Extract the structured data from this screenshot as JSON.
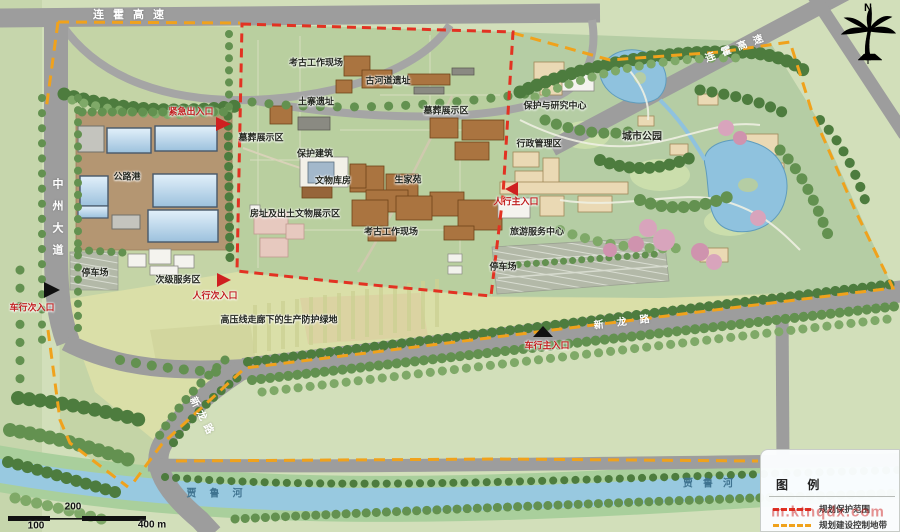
{
  "roads": {
    "lianhuo_top": "连霍高速",
    "lianhuo_ne": "连霍高速",
    "zhongzhou": "中州大道",
    "xinlong_e": "新龙路",
    "xinlong_sw": "新龙路"
  },
  "rivers": {
    "jialuhe_w": "贾鲁河",
    "jialuhe_e": "贾鲁河"
  },
  "areas": {
    "gonglugang": "公路港",
    "tingchechang_left": "停车场",
    "cijifuwuqu": "次级服务区",
    "kaogu_top": "考古工作现场",
    "guhedao": "古河道遗址",
    "tuzhai": "土寨遗址",
    "muzang_left": "墓葬展示区",
    "muzang_right": "墓葬展示区",
    "baohu_jianzhu": "保护建筑",
    "wenwu_kufang": "文物库房",
    "shengjiayuan": "生家苑",
    "fangzhi": "房址及出土文物展示区",
    "kaogu_bottom": "考古工作现场",
    "baohu_yanjiu": "保护与研究中心",
    "xingzheng": "行政管理区",
    "chengshi_gongyuan": "城市公园",
    "lvyou_fuwu": "旅游服务中心",
    "tingchechang_right": "停车场",
    "gaoyaxian": "高压线走廊下的生产防护绿地"
  },
  "entrances": {
    "jinji": "紧急出入口",
    "renxing_ci": "人行次入口",
    "chexing_ci": "车行次入口",
    "renxing_zhu": "人行主入口",
    "chexing_zhu": "车行主入口"
  },
  "north_label": "N",
  "scale": {
    "m100": "100",
    "m200": "200",
    "m400": "400 m"
  },
  "legend": {
    "title": "图 例",
    "items": [
      {
        "name": "protection-scope",
        "label": "规划保护范围",
        "color": "#e23222",
        "style": "dashed"
      },
      {
        "name": "construction-control-zone",
        "label": "规划建设控制地带",
        "color": "#f0a21c",
        "style": "dashed"
      }
    ]
  },
  "watermark": "m.ktnqdx.com",
  "colors": {
    "protection_boundary": "#e23222",
    "control_boundary": "#f0a21c",
    "road": "#9d9d9d",
    "water": "#98c9e0",
    "site_green": "#c4d4a6",
    "core_green": "#b9cf9f",
    "field_band": "#dadfa8"
  }
}
